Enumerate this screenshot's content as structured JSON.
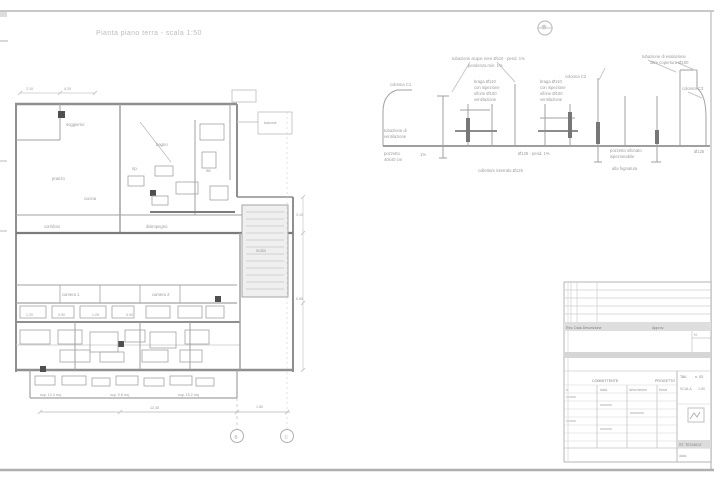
{
  "sheet": {
    "title": "Pianta piano terra - scala 1:50",
    "bg_color": "#ffffff",
    "border_color": "#c6c6c6",
    "line_color": "#a2a2a2",
    "dark_line_color": "#7c7c7c"
  },
  "icons": {
    "north_reference": "circle-crosshair"
  },
  "schematic": {
    "caption": "schema colonne di scarico",
    "labels": {
      "left_top": "colonna C1",
      "left_mid1": "tubazione di",
      "left_mid2": "ventilazione",
      "left_low1": "pozzetto",
      "left_low2": "40x40 cm",
      "top_long": "tubazione acque nere Ø110 - pend. 1%",
      "top_sub": "pendenza min. 1%",
      "stack1a": "braga Ø110",
      "stack1b": "con ispezione",
      "stack1c": "sifone Ø100",
      "stack1d": "ventilazione",
      "stack2a": "braga Ø110",
      "stack2b": "con ispezione",
      "stack2c": "sifone Ø100",
      "stack2d": "ventilazione",
      "mid_right": "colonna C2",
      "top_right1": "tubazione di esalazione",
      "top_right2": "oltre copertura Ø100",
      "right_label": "colonna C3",
      "below_left": "1%",
      "below_center": "Ø125 - pend. 1%",
      "below_right1": "pozzetto sifonato",
      "below_right2": "ispezionabile",
      "below_right3": "alla fognatura",
      "bottom_mid": "collettore interrato Ø125",
      "bottom_right": "Ø125"
    }
  },
  "plan": {
    "caption": "pianta",
    "rooms": {
      "soggiorno": "soggiorno",
      "pranzo": "pranzo",
      "cucina": "cucina",
      "bagno": "bagno",
      "wc": "wc",
      "rip": "rip.",
      "corridoio": "corridoio",
      "disimpegno": "disimpegno",
      "camera1": "camera 1",
      "camera2": "camera 2",
      "scala": "scala",
      "balcone": "balcone"
    },
    "dims": {
      "top1": "2.10",
      "top2": "4.20",
      "bottom_total": "12.45",
      "bottom_right": "1.50",
      "right1": "3.10",
      "right2": "6.85",
      "row1": "1.20",
      "row2": "0.90",
      "row3": "1.25",
      "row4": "0.90"
    },
    "notes": {
      "n1": "sup. 12.4 mq",
      "n2": "sup. 9.8 mq",
      "n3": "sup. 15.2 mq"
    },
    "grid": {
      "b1": "B",
      "b2": "C"
    }
  },
  "titleblock": {
    "rev_header": "Rev.  Data  Descrizione",
    "appr_header": "Approv.",
    "notch_label": "N.",
    "client_header": "COMMITTENTE",
    "project_header": "PROGETTO",
    "col1": "n.",
    "col2": "data",
    "col3": "descrizione",
    "col4": "firma",
    "sheet_label": "TAV.",
    "sheet_number": "n. 03",
    "scale_label": "SCALA",
    "scale_value": "1:50",
    "firm": "ST. TECNICO",
    "date_label": "data:"
  }
}
